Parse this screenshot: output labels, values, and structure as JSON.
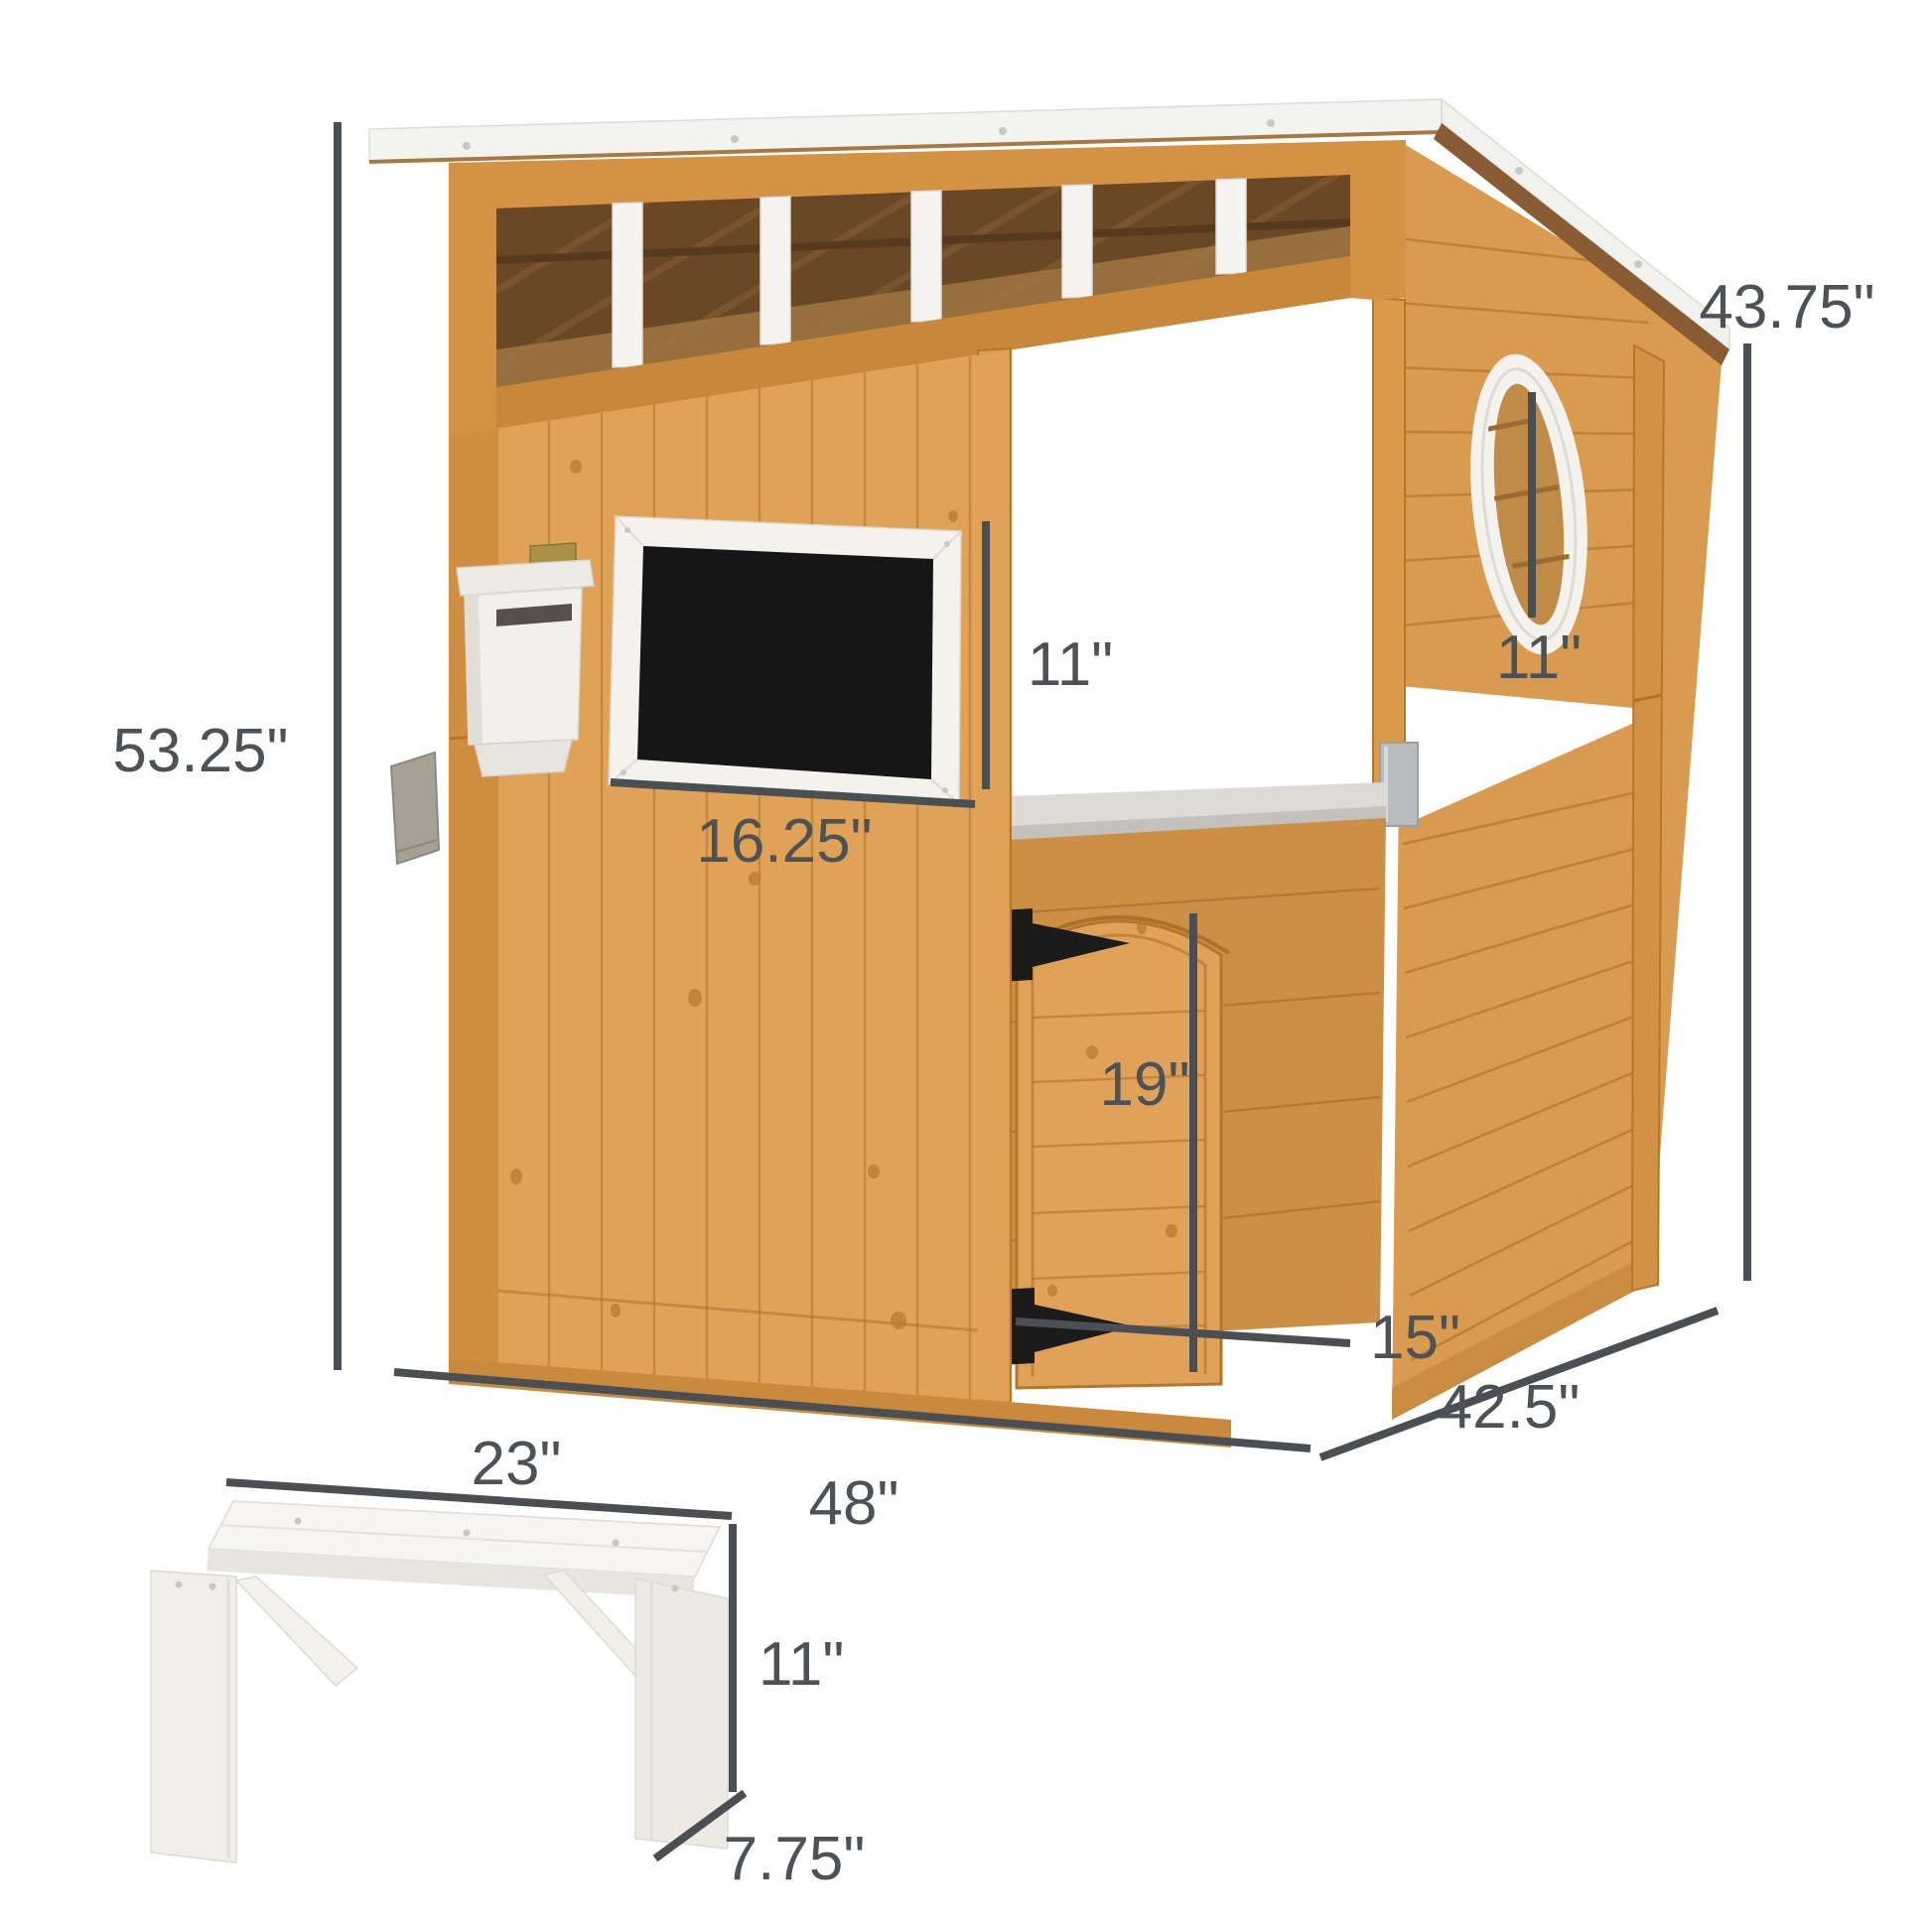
{
  "page": {
    "background": "#ffffff",
    "kind": "product-dimension-diagram"
  },
  "product": {
    "label": "Wooden kids playhouse with chalkboard, mailbox, porthole window, serving counter, small arched door and white bench"
  },
  "colors": {
    "dimension_line": "#4a4f54",
    "dimension_text": "#4d5257",
    "wood": "#dfa257",
    "wood_dark": "#c8883c",
    "wood_line": "#a9712c",
    "interior_dark": "#6a4826",
    "roof_white": "#f3f3f0",
    "trim_white": "#f5f4f0",
    "chalkboard_black": "#161616",
    "metal_silver": "#b8bcbf",
    "hinge_black": "#1b1b1b",
    "bench_white": "#f2f1eb",
    "planter_gray": "#a7a195"
  },
  "dimensions": {
    "front_height": "53.25\"",
    "rear_height": "43.75\"",
    "chalkboard_height": "11\"",
    "chalkboard_width": "16.25\"",
    "porthole_diameter": "11\"",
    "small_door_height": "19\"",
    "small_door_width": "15\"",
    "house_width": "48\"",
    "house_depth": "42.5\"",
    "bench_length": "23\"",
    "bench_height": "11\"",
    "bench_depth": "7.75\""
  }
}
